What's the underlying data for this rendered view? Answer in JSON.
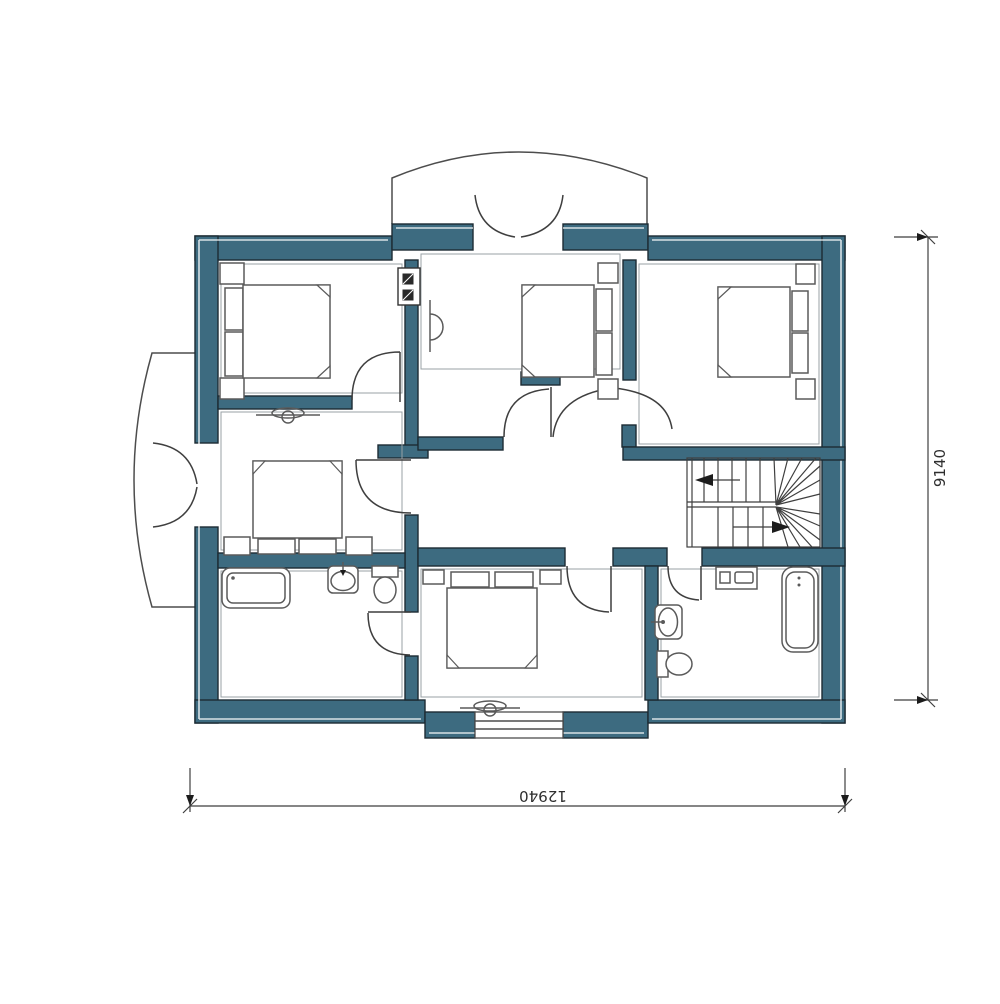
{
  "colors": {
    "background": "#ffffff",
    "wall_fill": "#3d6b80",
    "wall_stroke": "#1c2b33",
    "dim_line": "#3f3f3f"
  },
  "dimensions": {
    "bottom": {
      "label": "12940"
    },
    "right": {
      "label": "9140"
    }
  },
  "plan": {
    "type": "floor-plan",
    "inventory": {
      "bedrooms": 5,
      "beds": 5,
      "bathrooms": 2,
      "bathtubs": 2,
      "toilets": 2,
      "sinks": 2,
      "washing_machines": 1,
      "staircases": 1,
      "staircase_style": "u-shaped-with-winders",
      "balconies": 2,
      "balcony_double_doors": 2,
      "windows": 1,
      "electrical_panels": 1,
      "wall_lights": 3,
      "interior_doors": 7
    }
  }
}
